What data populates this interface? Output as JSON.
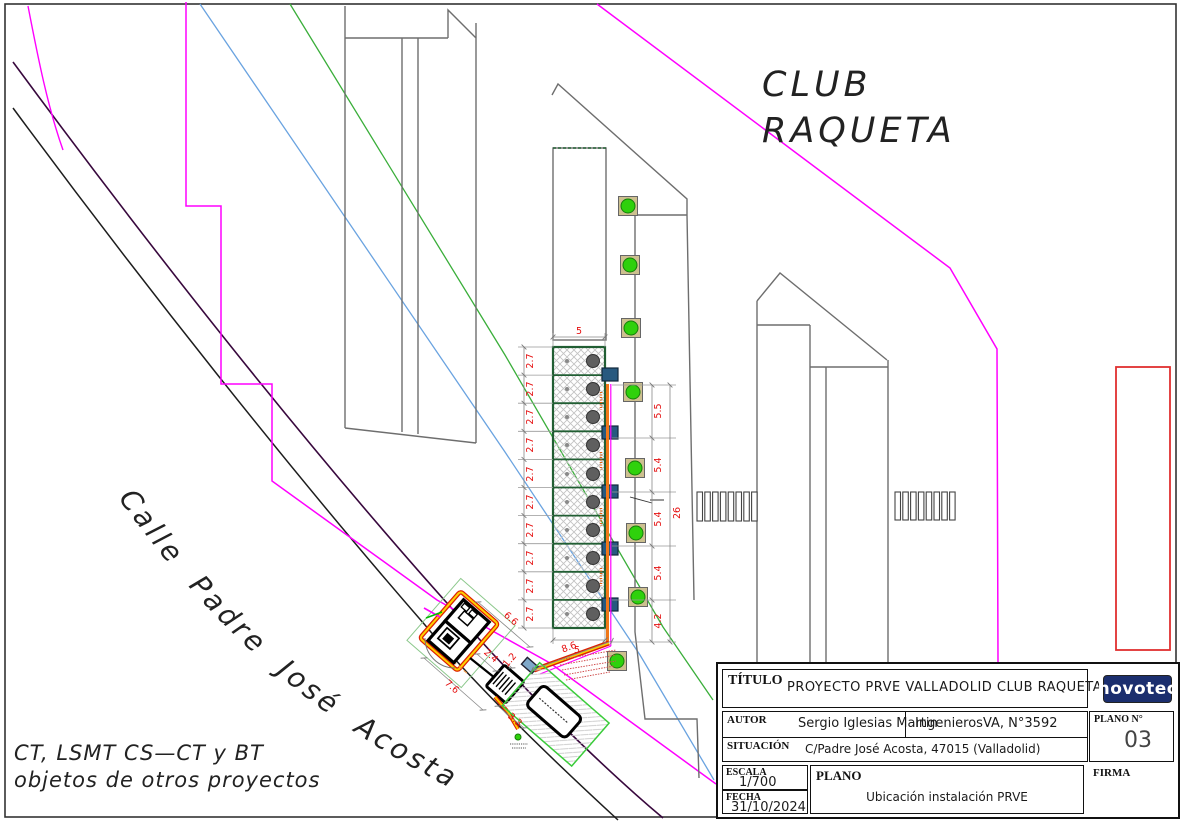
{
  "drawing": {
    "club_line1": "CLUB",
    "club_line2": "RAQUETA",
    "street_label": "Calle  Padre  José  Acosta",
    "note_line1": "CT, LSMT CS—CT y BT",
    "note_line2": "objetos de otros proyectos",
    "dimensions": {
      "stall_width": [
        "2.7",
        "2.7",
        "2.7",
        "2.7",
        "2.7",
        "2.7",
        "2.7",
        "2.7",
        "2.7",
        "2.7"
      ],
      "stall_length_top": "5",
      "stall_length_bottom": "5",
      "right_chain": [
        "5.5",
        "5.4",
        "5.4",
        "5.4",
        "4.2"
      ],
      "right_total": "26",
      "access_run": "8.6",
      "ct_w1": "6.6",
      "ct_w2": "2.4",
      "ct_w3": "1.2",
      "ct_w4": "7.6",
      "ct_w5": "3.3"
    }
  },
  "title_block": {
    "titulo_label": "TÍTULO",
    "titulo_value": "PROYECTO PRVE VALLADOLID CLUB RAQUETA",
    "autor_label": "AUTOR",
    "autor_value": "Sergio Iglesias Martin",
    "autor_org": "IngenierosVA, N°3592",
    "situacion_label": "SITUACIÓN",
    "situacion_value": "C/Padre José Acosta, 47015 (Valladolid)",
    "escala_label": "ESCALA",
    "escala_value": "1/700",
    "fecha_label": "FECHA",
    "fecha_value": "31/10/2024",
    "plano_label": "PLANO",
    "plano_value": "Ubicación instalación PRVE",
    "plano_num_label": "PLANO  N°",
    "plano_num_value": "03",
    "firma_label": "FIRMA",
    "logo_text": "novotec"
  },
  "colors": {
    "boundary_magenta": "#ff00ff",
    "utility_purple": "#38083d",
    "utility_blue": "#6aa3e0",
    "utility_green": "#3aae3a",
    "stall_green": "#215e33",
    "dim_red": "#e51010",
    "conduit_red": "#dd2200",
    "conduit_yellow": "#ffd000",
    "conduit_orange": "#f07818",
    "tree_green": "#2fd10c",
    "charger_blue": "#27597f",
    "reserve_red": "#e03030",
    "logo_navy": "#1b2e6e"
  }
}
